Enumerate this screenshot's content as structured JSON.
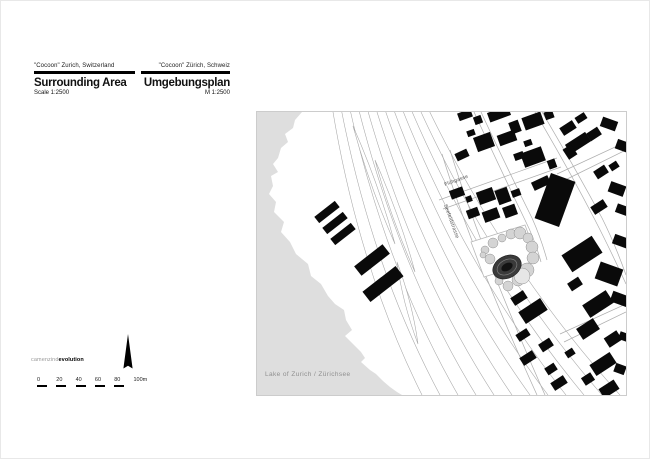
{
  "title_block": {
    "left": {
      "eyebrow": "\"Cocoon\" Zurich, Switzerland",
      "title": "Surrounding Area",
      "scale": "Scale 1:2500"
    },
    "right": {
      "eyebrow": "\"Cocoon\" Zürich, Schweiz",
      "title": "Umgebungsplan",
      "scale": "M 1:2500"
    }
  },
  "logo": {
    "light": "camenzind",
    "bold": "evolution"
  },
  "scalebar": {
    "ticks": [
      "0",
      "20",
      "40",
      "60",
      "80"
    ],
    "last": "100m"
  },
  "map": {
    "labels": {
      "street_1": "Flühgasse",
      "street_2": "Seefeldstrasse",
      "lake": "Lake of Zurich / Zürichsee"
    },
    "colors": {
      "lake": "#dedede",
      "building": "#0a0a0a",
      "rail_line": "#a6a6a6",
      "street_line": "#adadad",
      "tree_fill": "#d4d4d4",
      "cocoon_fill": "#3a3a3a",
      "lake_label": "#8f8f8f"
    }
  }
}
